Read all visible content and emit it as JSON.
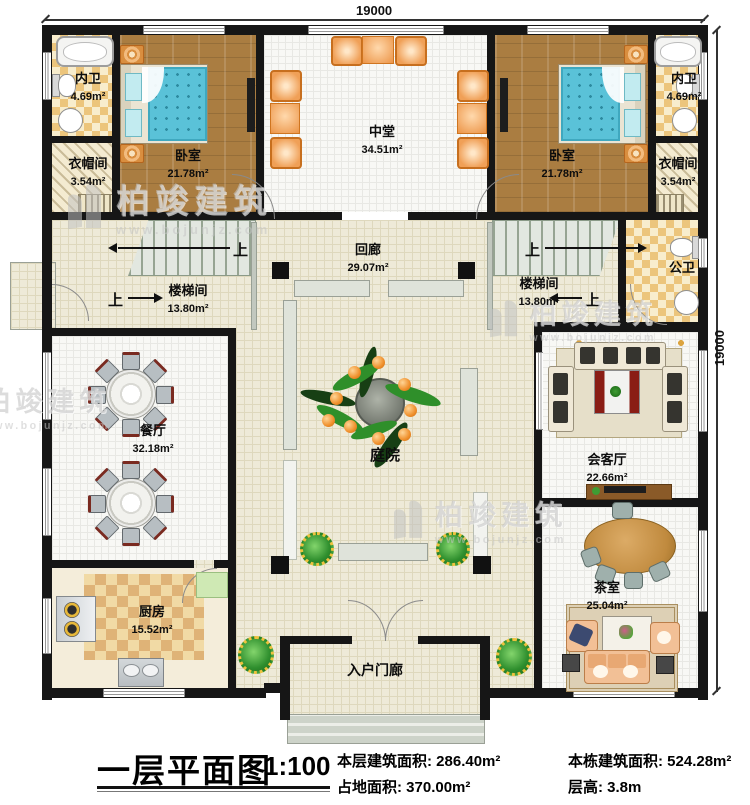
{
  "dimensions": {
    "top": "19000",
    "right": "19000"
  },
  "rooms": {
    "neiwei": {
      "name": "内卫",
      "area": "4.69m²"
    },
    "bedroom": {
      "name": "卧室",
      "area": "21.78m²"
    },
    "zhongtang": {
      "name": "中堂",
      "area": "34.51m²"
    },
    "yimaojian": {
      "name": "衣帽间",
      "area": "3.54m²"
    },
    "huilang": {
      "name": "回廊",
      "area": "29.07m²"
    },
    "stair": {
      "name": "楼梯间",
      "area": "13.80m²"
    },
    "gongwei": {
      "name": "公卫"
    },
    "canting": {
      "name": "餐厅",
      "area": "32.18m²"
    },
    "tingyuan": {
      "name": "庭院"
    },
    "huiketing": {
      "name": "会客厅",
      "area": "22.66m²"
    },
    "chashi": {
      "name": "茶室",
      "area": "25.04m²"
    },
    "chufang": {
      "name": "厨房",
      "area": "15.52m²"
    },
    "porch": {
      "name": "入户门廊"
    }
  },
  "stairs": {
    "up_label": "上"
  },
  "watermark": {
    "brand": "柏竣建筑",
    "url": "www.bojunjz.com"
  },
  "title_block": {
    "title": "一层平面图",
    "scale": "1:100",
    "stats": [
      "本层建筑面积: 286.40m²",
      "占地面积: 370.00m²",
      "本栋建筑面积: 524.28m²",
      "层高: 3.8m"
    ]
  }
}
